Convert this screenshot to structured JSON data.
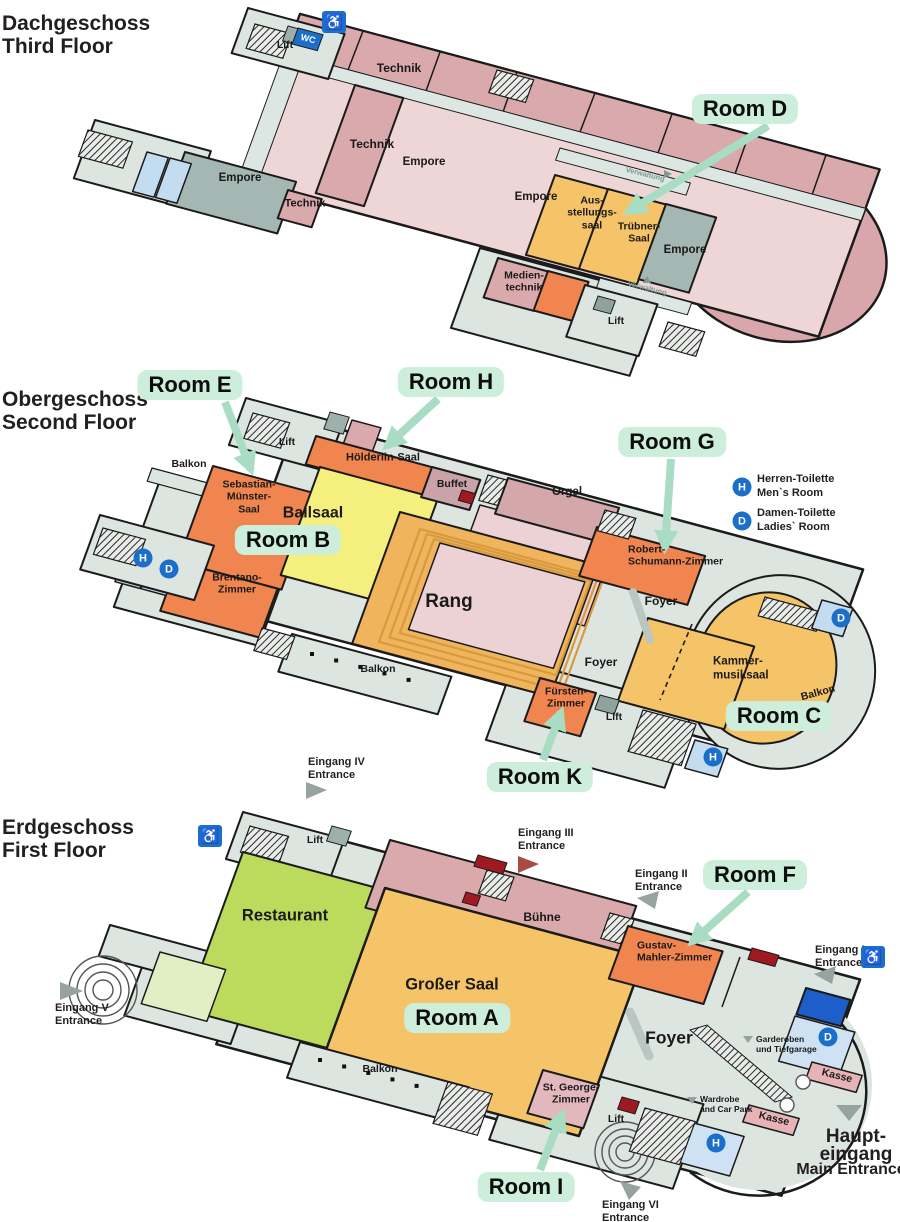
{
  "floors": [
    {
      "id": "f3",
      "title_de": "Dachgeschoss",
      "title_en": "Third Floor",
      "labels": [
        {
          "id": "lift_top",
          "text": "Lift"
        },
        {
          "id": "technik_top",
          "text": "Technik"
        },
        {
          "id": "technik_mid",
          "text": "Technik"
        },
        {
          "id": "empore_a",
          "text": "Empore"
        },
        {
          "id": "empore_left",
          "text": "Empore"
        },
        {
          "id": "technik_small",
          "text": "Technik"
        },
        {
          "id": "verwaltung_1",
          "text": "Verwaltung"
        },
        {
          "id": "empore_b",
          "text": "Empore"
        },
        {
          "id": "ausstellung",
          "text": "Aus-\nstellungs-\nsaal"
        },
        {
          "id": "truebner",
          "text": "Trübner-\nSaal"
        },
        {
          "id": "empore_right",
          "text": "Empore"
        },
        {
          "id": "verwaltung_2",
          "text": "Verwaltung"
        },
        {
          "id": "medientechnik",
          "text": "Medien-\ntechnik"
        },
        {
          "id": "lift_bottom",
          "text": "Lift"
        }
      ]
    },
    {
      "id": "f2",
      "title_de": "Obergeschoss",
      "title_en": "Second Floor",
      "labels": [
        {
          "id": "balkon_top",
          "text": "Balkon"
        },
        {
          "id": "lift_top",
          "text": "Lift"
        },
        {
          "id": "hoelderlin",
          "text": "Hölderlin-Saal"
        },
        {
          "id": "sebastian",
          "text": "Sebastian-\nMünster-\nSaal"
        },
        {
          "id": "ballsaal",
          "text": "Ballsaal"
        },
        {
          "id": "buffet",
          "text": "Buffet"
        },
        {
          "id": "orgel",
          "text": "Orgel"
        },
        {
          "id": "brentano",
          "text": "Brentano-\nZimmer"
        },
        {
          "id": "rang",
          "text": "Rang"
        },
        {
          "id": "robert",
          "text": "Robert-\nSchumann-Zimmer"
        },
        {
          "id": "foyer_top",
          "text": "Foyer"
        },
        {
          "id": "foyer_mid",
          "text": "Foyer"
        },
        {
          "id": "kammer",
          "text": "Kammer-\nmusiksaal"
        },
        {
          "id": "fuersten",
          "text": "Fürsten-\nZimmer"
        },
        {
          "id": "lift_bottom",
          "text": "Lift"
        },
        {
          "id": "balkon_bottom",
          "text": "Balkon"
        },
        {
          "id": "balkon_right",
          "text": "Balkon"
        }
      ]
    },
    {
      "id": "f1",
      "title_de": "Erdgeschoss",
      "title_en": "First Floor",
      "labels": [
        {
          "id": "lift_top",
          "text": "Lift"
        },
        {
          "id": "restaurant",
          "text": "Restaurant"
        },
        {
          "id": "buehne",
          "text": "Bühne"
        },
        {
          "id": "grosser_saal",
          "text": "Großer Saal"
        },
        {
          "id": "gustav",
          "text": "Gustav-\nMahler-Zimmer"
        },
        {
          "id": "foyer",
          "text": "Foyer"
        },
        {
          "id": "balkon",
          "text": "Balkon"
        },
        {
          "id": "st_george",
          "text": "St. George-\nZimmer"
        },
        {
          "id": "lift_bottom",
          "text": "Lift"
        },
        {
          "id": "garderoben",
          "text": "Garderoben\nund Tiefgarage"
        },
        {
          "id": "wardrobe",
          "text": "Wardrobe\nand Car Park"
        },
        {
          "id": "kasse_1",
          "text": "Kasse"
        },
        {
          "id": "kasse_2",
          "text": "Kasse"
        }
      ]
    }
  ],
  "badges": [
    {
      "id": "room-d",
      "text": "Room D"
    },
    {
      "id": "room-e",
      "text": "Room E"
    },
    {
      "id": "room-h",
      "text": "Room H"
    },
    {
      "id": "room-g",
      "text": "Room G"
    },
    {
      "id": "room-b",
      "text": "Room B"
    },
    {
      "id": "room-c",
      "text": "Room C"
    },
    {
      "id": "room-k",
      "text": "Room K"
    },
    {
      "id": "room-f",
      "text": "Room F"
    },
    {
      "id": "room-a",
      "text": "Room A"
    },
    {
      "id": "room-i",
      "text": "Room I"
    }
  ],
  "entrances": [
    {
      "id": "eingang-5",
      "de": "Eingang V",
      "en": "Entrance"
    },
    {
      "id": "eingang-4",
      "de": "Eingang IV",
      "en": "Entrance"
    },
    {
      "id": "eingang-3",
      "de": "Eingang III",
      "en": "Entrance"
    },
    {
      "id": "eingang-2",
      "de": "Eingang II",
      "en": "Entrance"
    },
    {
      "id": "eingang-1",
      "de": "Eingang I",
      "en": "Entrance"
    },
    {
      "id": "eingang-6",
      "de": "Eingang VI",
      "en": "Entrance"
    },
    {
      "id": "haupteingang",
      "de": "Haupt-\neingang",
      "en": "Main Entrance"
    }
  ],
  "legend": {
    "herren": "Herren-Toilette\nMen`s Room",
    "damen": "Damen-Toilette\nLadies` Room"
  },
  "icons": {
    "wc": "WC",
    "wheelchair": "♿",
    "h": "H",
    "d": "D"
  },
  "colors": {
    "badge_bg": "#cdeeda",
    "arrow_green": "#a8ddc3",
    "icon_blue": "#1b6ec9",
    "orange": "#f08550",
    "gold": "#f6c468",
    "ballsaal_yellow": "#f5ef7d",
    "restaurant_green": "#bcdb5c",
    "pink_room": "#d9a9ab",
    "light_pink": "#eed6d7",
    "dark_red": "#9e1a20",
    "dark_blue": "#1d5ecb",
    "light_blue": "#c3dcf0",
    "gray_floor": "#dde5e1",
    "gray_green": "#a4b7b2",
    "kasse_pink": "#e7b3b7"
  }
}
